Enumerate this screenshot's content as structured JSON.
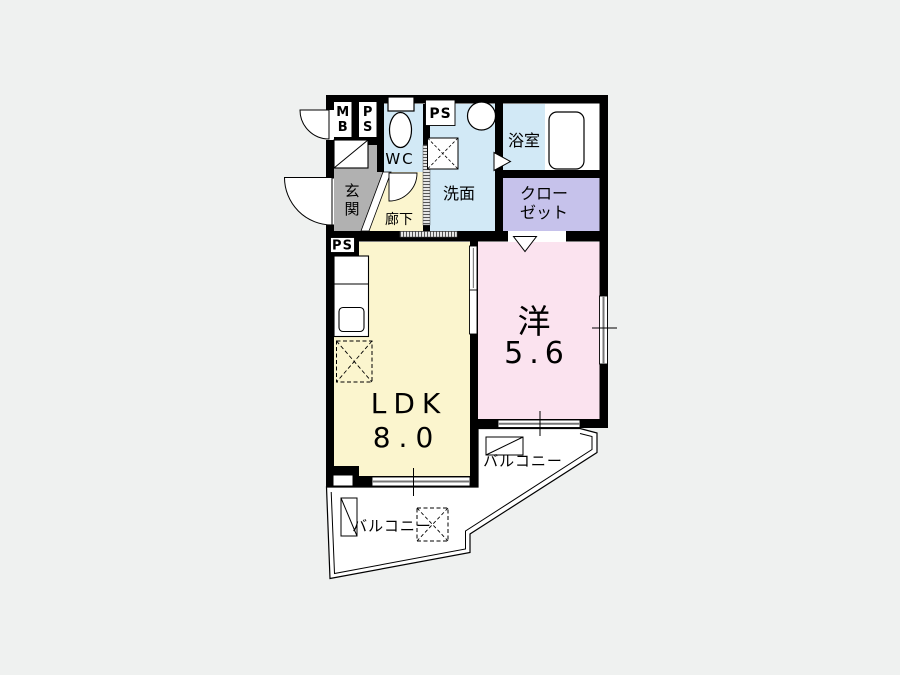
{
  "floorplan": {
    "colors": {
      "background": "#EFF1F0",
      "plan_bg": "#FFFFFF",
      "ldk": "#FBF5CE",
      "hallway": "#FBF5CE",
      "western_room": "#FBE3EF",
      "closet": "#C6C2EB",
      "wet_area": "#D2E9F6",
      "entrance": "#B1B1B1",
      "wall": "#000000"
    },
    "meter_box": {
      "line1": "M",
      "line2": "B"
    },
    "pipe_space_left": {
      "line1": "P",
      "line2": "S"
    },
    "pipe_space_top": "PS",
    "pipe_space_kitchen": "PS",
    "wc": "WC",
    "washroom": "洗面",
    "bathroom": "浴室",
    "closet": {
      "line1": "クロー",
      "line2": "ゼット"
    },
    "entrance": {
      "char1": "玄",
      "char2": "関"
    },
    "hallway": "廊下",
    "ldk": {
      "name": "LDK",
      "size": "8.0"
    },
    "western_room": {
      "name": "洋",
      "size": "5.6"
    },
    "balcony_right": "バルコニー",
    "balcony_bottom": "バルコニー"
  }
}
